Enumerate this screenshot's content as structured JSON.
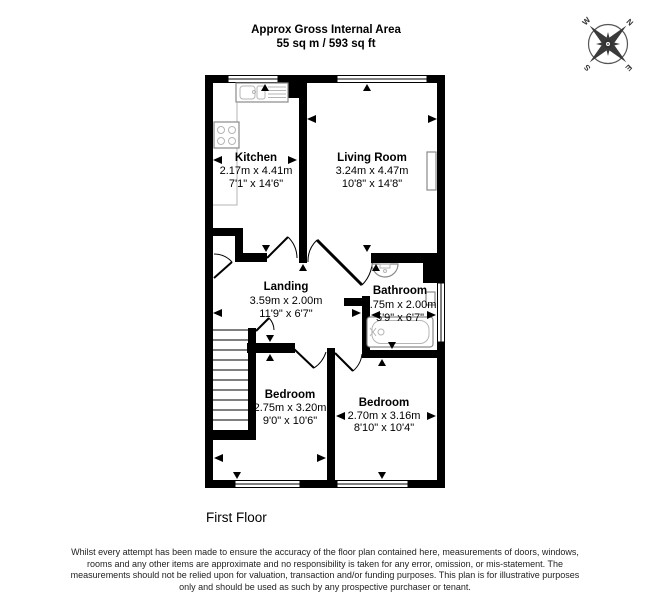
{
  "header": {
    "line1": "Approx Gross Internal Area",
    "line2": "55 sq m / 593 sq ft"
  },
  "floor_label": "First Floor",
  "compass": {
    "n": "N",
    "e": "E",
    "s": "S",
    "w": "W"
  },
  "rooms": [
    {
      "name": "Kitchen",
      "metric": "2.17m x 4.41m",
      "imperial": "7'1\" x 14'6\""
    },
    {
      "name": "Living Room",
      "metric": "3.24m x 4.47m",
      "imperial": "10'8\" x 14'8\""
    },
    {
      "name": "Landing",
      "metric": "3.59m x 2.00m",
      "imperial": "11'9\" x 6'7\""
    },
    {
      "name": "Bathroom",
      "metric": "1.75m x 2.00m",
      "imperial": "5'9\" x 6'7\""
    },
    {
      "name": "Bedroom",
      "metric": "2.75m x 3.20m",
      "imperial": "9'0\" x 10'6\""
    },
    {
      "name": "Bedroom",
      "metric": "2.70m x 3.16m",
      "imperial": "8'10\" x 10'4\""
    }
  ],
  "disclaimer": "Whilst every attempt has been made to ensure the accuracy of the floor plan contained here, measurements of doors, windows, rooms and any other items are approximate and no responsibility is taken for any error, omission, or mis-statement. This plan is for illustrative purposes only and should be used as such by any prospective purchaser or tenant. The measurements should not be relied upon for valuation, transaction and/or funding purposes.",
  "disclaimer_exact": "Whilst every attempt has been made to ensure the accuracy of the floor plan contained here, measurements of doors, windows, rooms and any other items are approximate and no responsibility is taken for any error, omission, or mis-statement. The measurements should not be relied upon for valuation, transaction and/or funding purposes. This plan is for illustrative purposes only and should be used as such by any prospective purchaser or tenant.",
  "colors": {
    "wall": "#000000",
    "fixture_stroke": "#8a8a8a",
    "compass": "#3a3a3a",
    "text": "#000000",
    "disclaimer_text": "#222222"
  }
}
